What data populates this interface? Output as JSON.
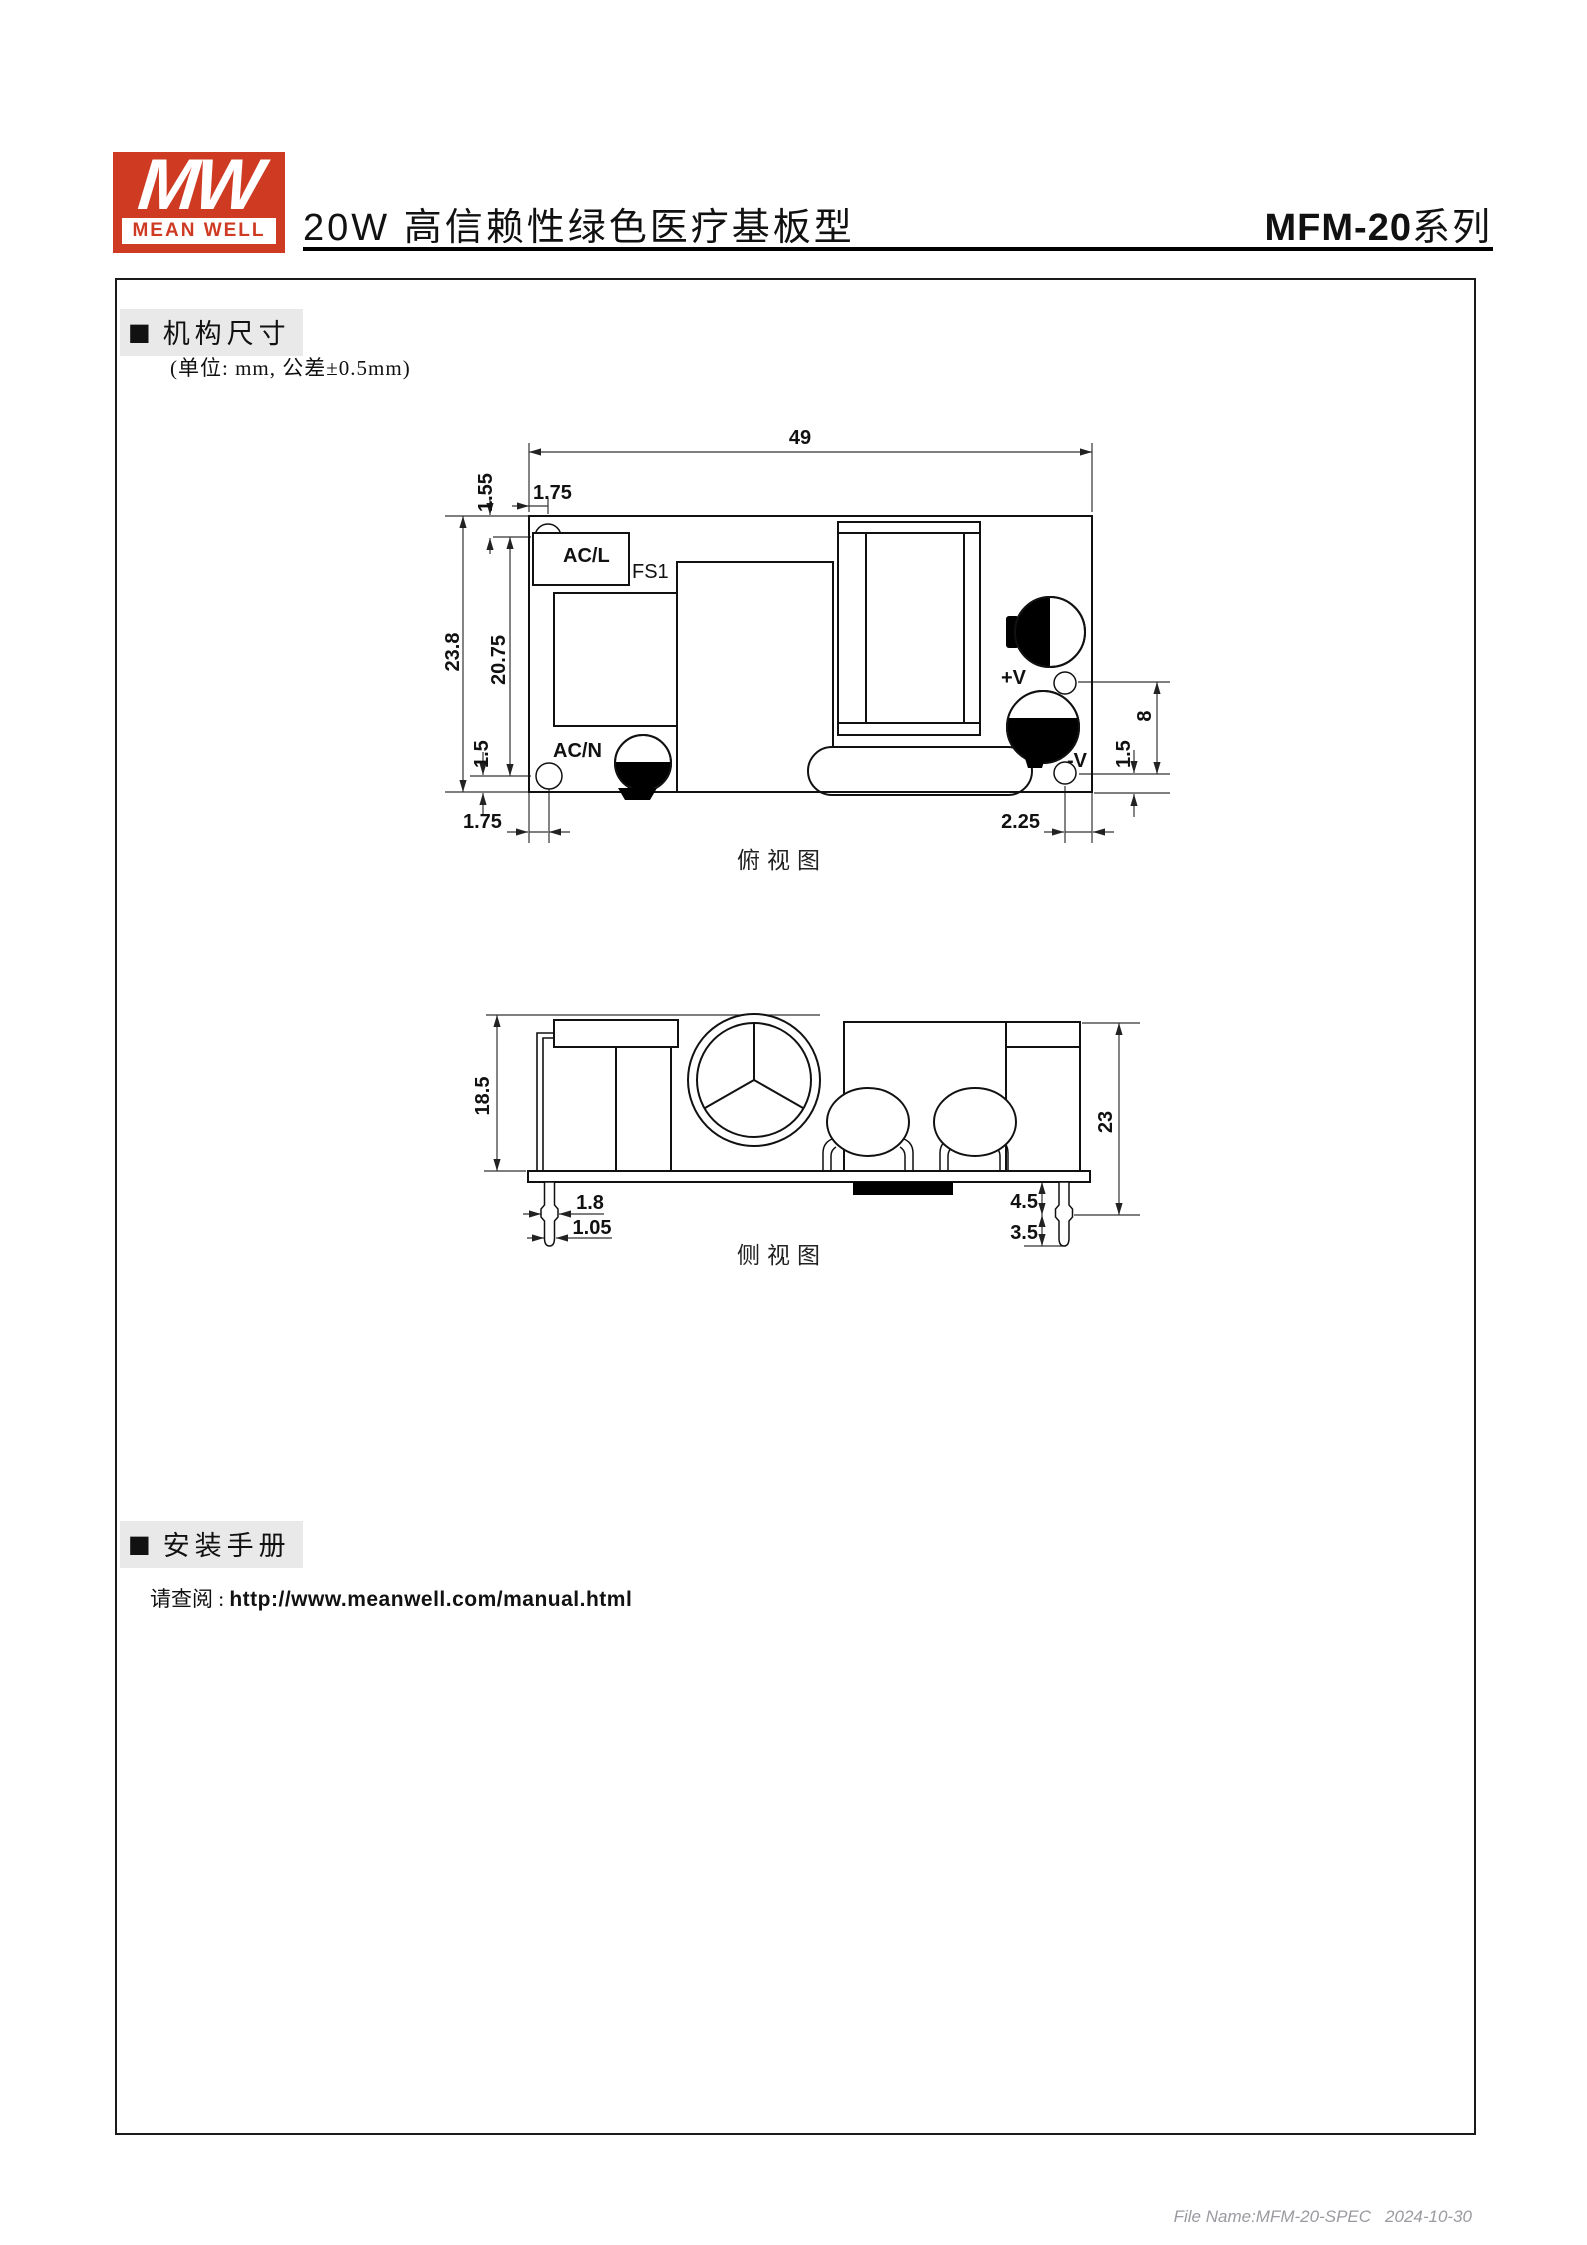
{
  "header": {
    "logo_mw": "MW",
    "brand": "MEAN WELL",
    "title": "20W 高信赖性绿色医疗基板型",
    "series": "MFM-20",
    "series_suffix": "系列",
    "accent_red": "#cf3a22"
  },
  "sections": {
    "bullet": "■",
    "mechanical_label": "机构尺寸",
    "unit_note": "(单位: mm, 公差±0.5mm)",
    "installation_label": "安装手册",
    "manual_prefix": "请查阅 : ",
    "manual_url": "http://www.meanwell.com/manual.html"
  },
  "top_view": {
    "caption": "俯视图",
    "labels": {
      "acl": "AC/L",
      "fs1": "FS1",
      "acn": "AC/N",
      "vplus": "+V",
      "vminus": "-V"
    },
    "dims": {
      "board_width": "49",
      "board_height": "23.8",
      "hole_offset_x_top": "1.75",
      "hole_offset_y_top": "1.55",
      "hole_span": "20.75",
      "hole_offset_y_bottom": "1.5",
      "hole_offset_x_bottom": "1.75",
      "pin_offset_right": "2.25",
      "pin_span": "8",
      "pin_offset_bottom": "1.5"
    }
  },
  "side_view": {
    "caption": "侧视图",
    "dims": {
      "component_height": "18.5",
      "overall_height": "23",
      "pin_crimp_width": "1.8",
      "pin_width": "1.05",
      "pin_standoff": "4.5",
      "pin_tip": "3.5"
    }
  },
  "footer": {
    "file_name": "File Name:MFM-20-SPEC",
    "date": "2024-10-30"
  }
}
